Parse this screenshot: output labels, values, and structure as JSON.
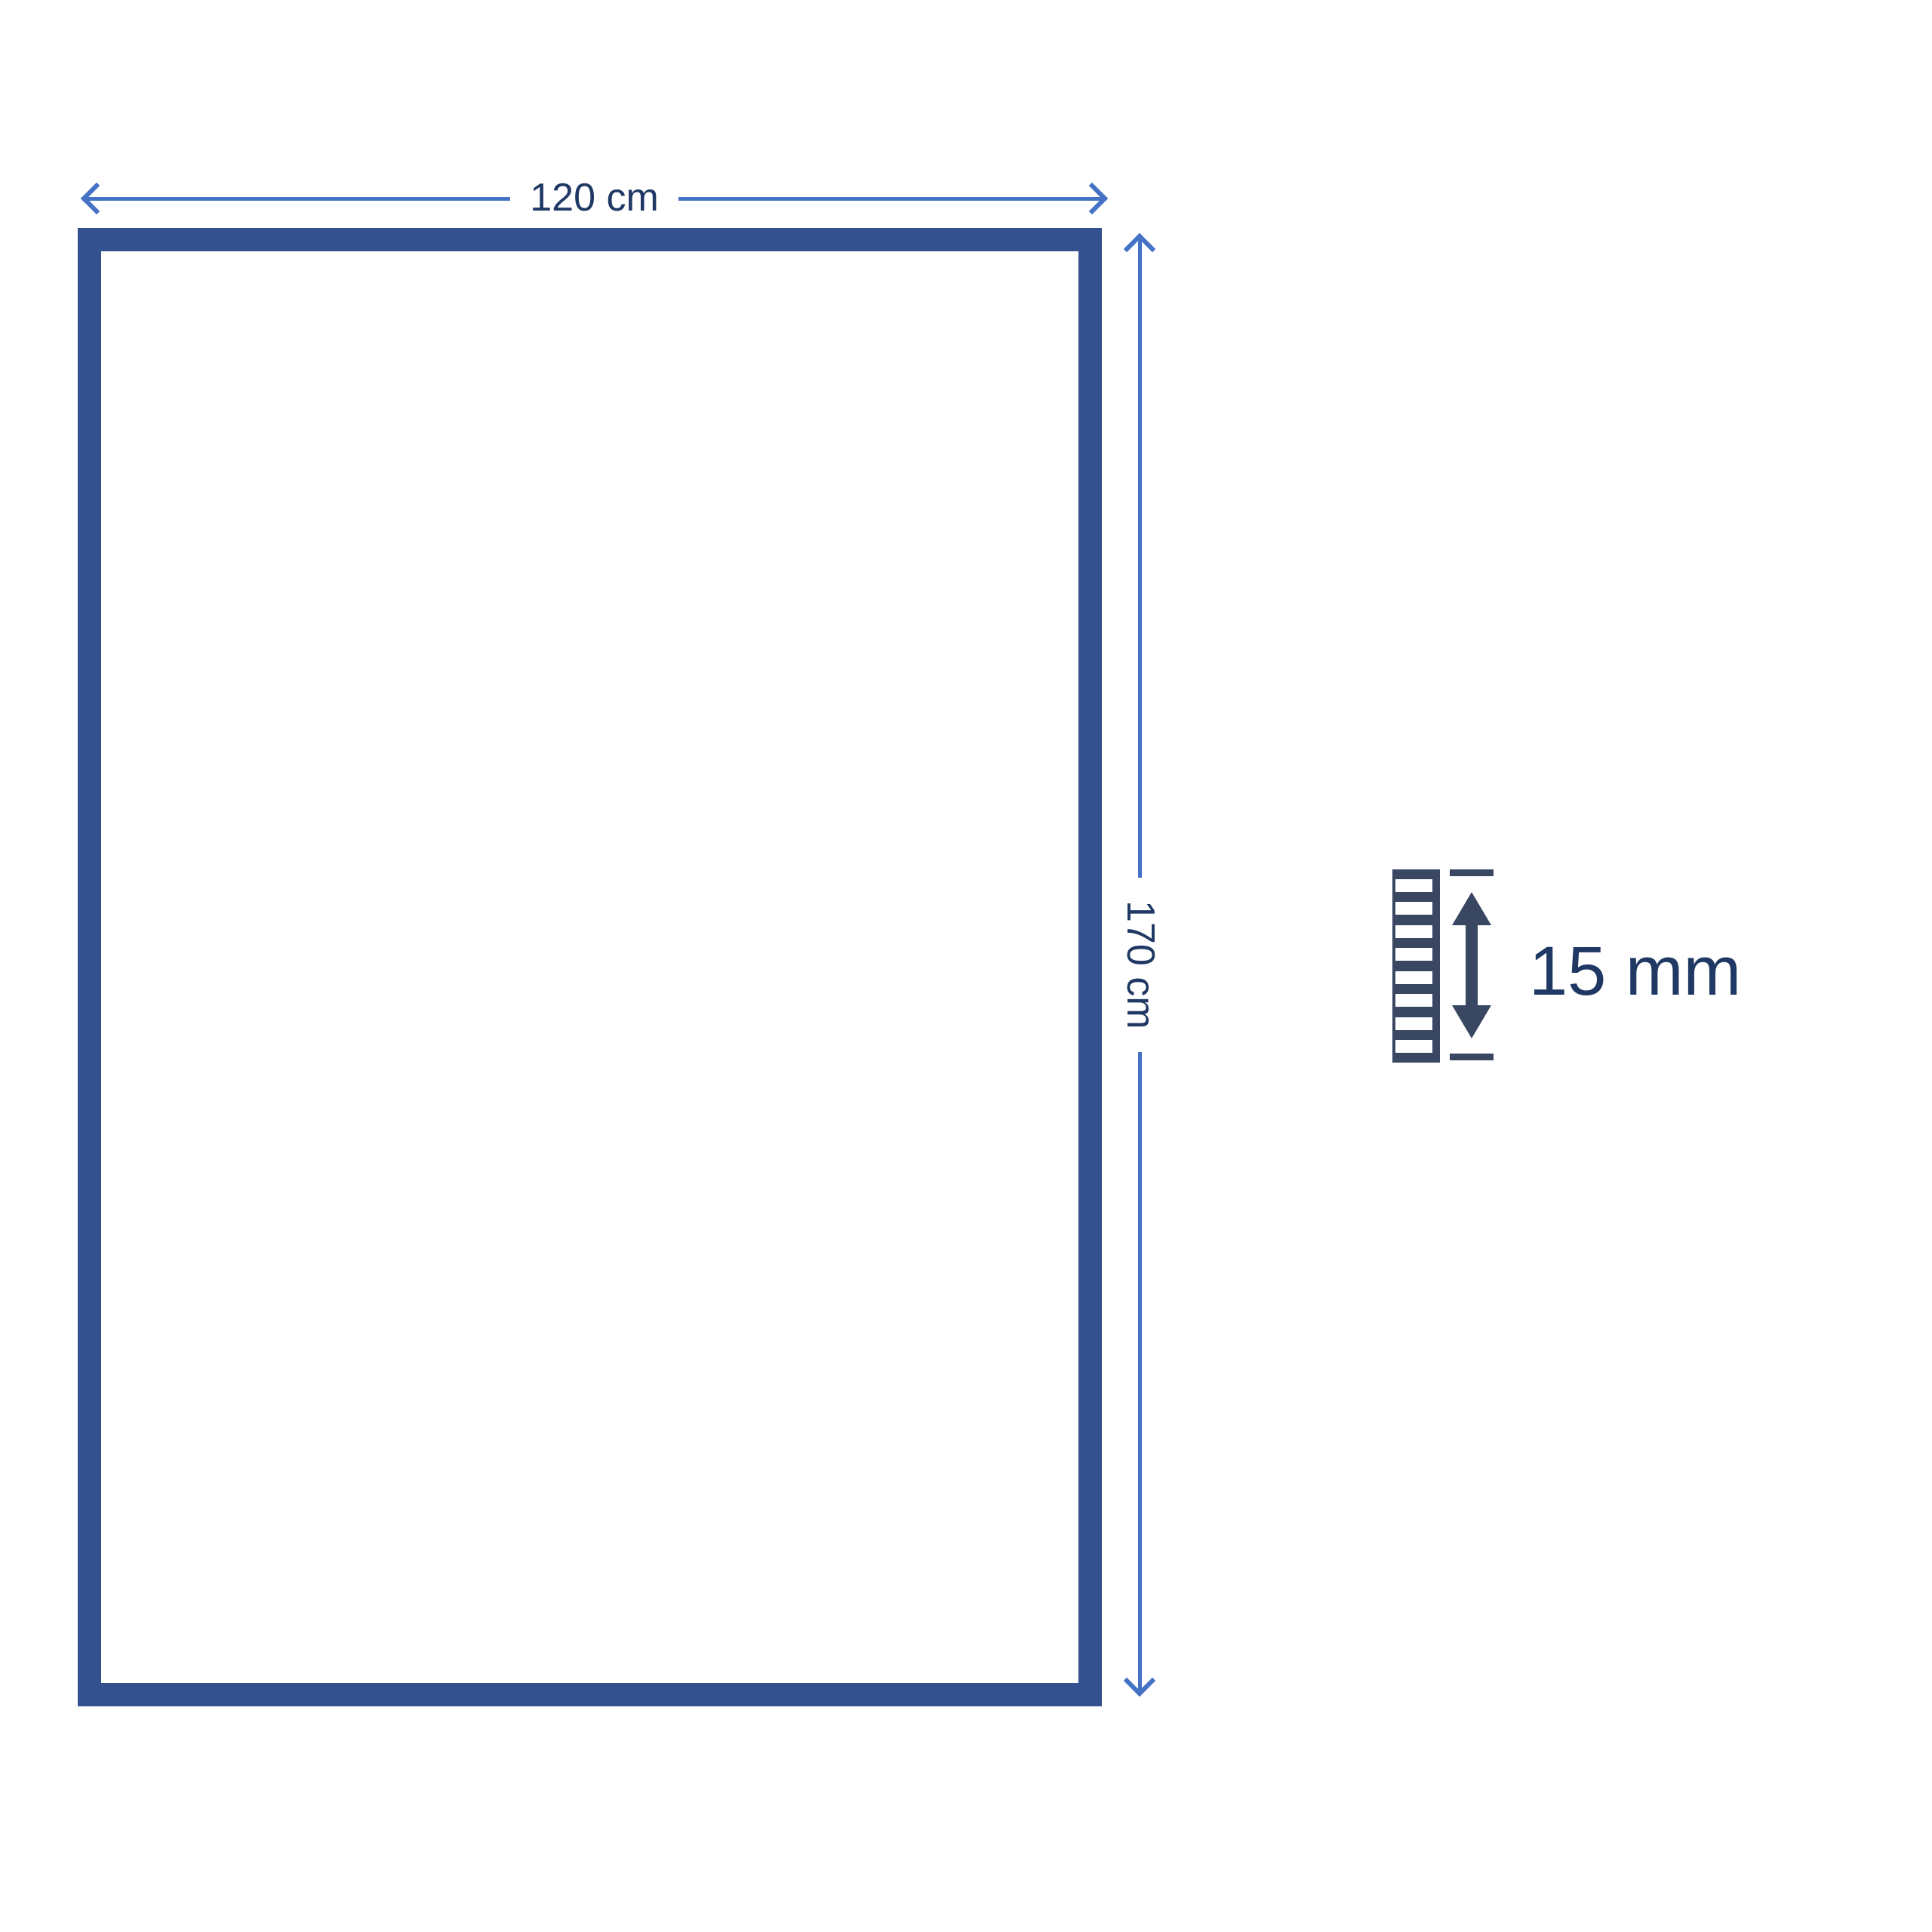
{
  "diagram": {
    "width": {
      "label": "120 cm"
    },
    "height": {
      "label": "170 cm"
    },
    "thickness": {
      "label": "15 mm"
    }
  },
  "icons": {
    "width_arrow": "left-right-dimension-arrow",
    "height_arrow": "up-down-dimension-arrow",
    "pile": "layer-stack-cross-section",
    "thickness_gauge": "double-headed-vertical-arrow-with-ticks"
  },
  "colors": {
    "frame_border": "#33518E",
    "dimension_line": "#4472C4",
    "label_text": "#1F3864",
    "thickness_icon": "#3A4763",
    "page_bg": "#FFFFFF"
  }
}
